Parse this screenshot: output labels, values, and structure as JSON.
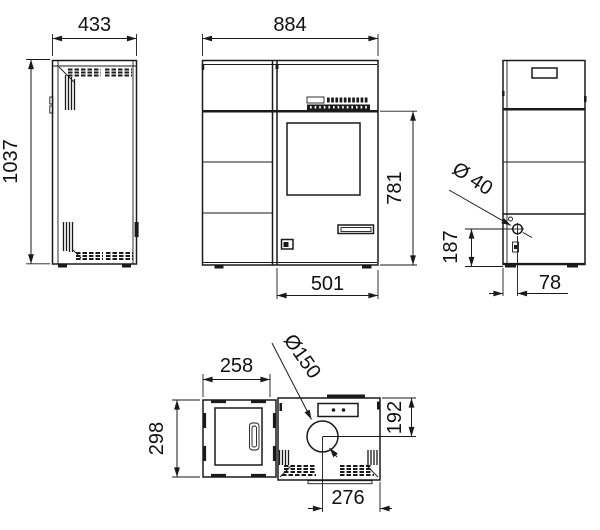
{
  "colors": {
    "line": "#1a1a1a",
    "background": "#ffffff"
  },
  "views": {
    "side_left": {
      "width_mm": "433",
      "height_mm": "1037"
    },
    "front": {
      "width_mm": "884",
      "right_section_height_mm": "781",
      "door_width_mm": "501"
    },
    "side_right": {
      "inlet_diameter": "Ø 40",
      "inlet_center_height_mm": "187",
      "inlet_offset_mm": "78"
    },
    "top": {
      "door_section_width_mm": "258",
      "flue_diameter": "Ø150",
      "door_section_depth_mm": "298",
      "flue_center_from_rear_mm": "192",
      "flue_center_from_right_mm": "276"
    }
  }
}
